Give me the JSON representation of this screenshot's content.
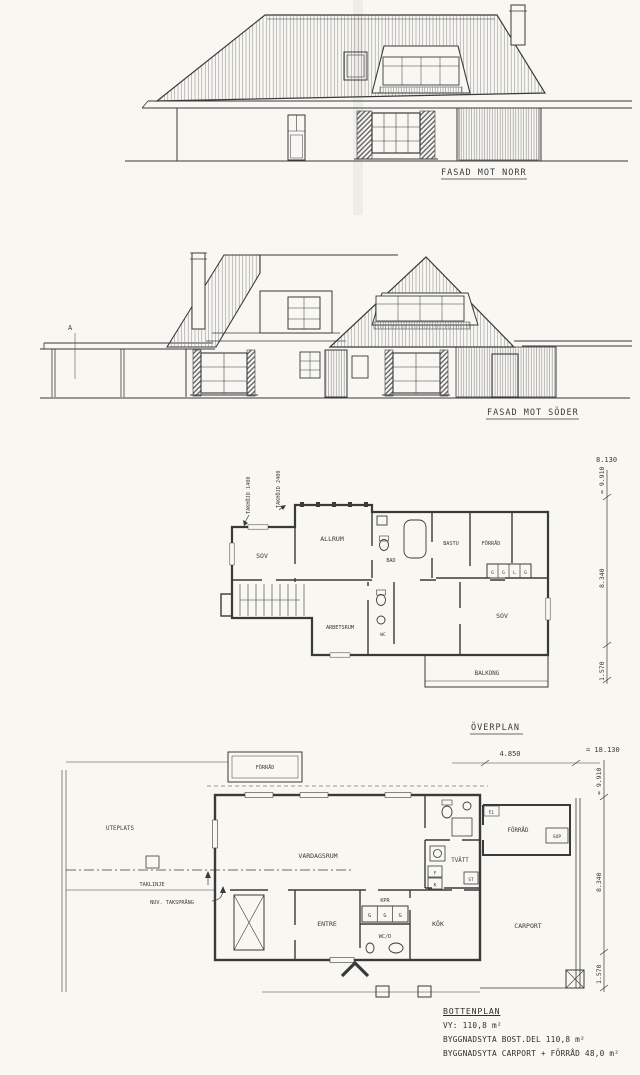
{
  "page": {
    "bg": "#f8f7f2",
    "ink": "#3a3a3a"
  },
  "elevations": {
    "north": {
      "caption": "FASAD MOT NORR"
    },
    "south": {
      "caption": "FASAD MOT SÖDER",
      "section_marker": "A"
    }
  },
  "overplan": {
    "caption": "ÖVERPLAN",
    "annotations": {
      "takhojd_low": "TAKHÖJD 1400",
      "takhojd_high": "TAKHÖJD 2400"
    },
    "rooms": {
      "sov_left": "SOV",
      "allrum": "ALLRUM",
      "bad": "BAD",
      "bastu": "BASTU",
      "forrad": "FÖRRÅD",
      "sov_right": "SOV",
      "arbetsrum": "ARBETSRUM",
      "wc": "WC",
      "balkong": "BALKONG"
    },
    "closets": [
      "G",
      "G",
      "L",
      "G"
    ],
    "dims": {
      "width_total": "8.130",
      "height_total": "= 9.910",
      "height_main": "8.340",
      "height_lower": "1.570"
    }
  },
  "bottenplan": {
    "rooms": {
      "forrad_top": "FÖRRÅD",
      "uteplats": "UTEPLATS",
      "vardagsrum": "VARDAGSRUM",
      "tvatt": "TVÄTT",
      "forrad_right": "FÖRRÅD",
      "sop": "SOP",
      "el": "EL",
      "entre": "ENTRE",
      "kpr": "KPR",
      "wcd": "WC/D",
      "kok": "KÖK",
      "carport": "CARPORT",
      "st": "ST",
      "frys": "F",
      "kyl": "K"
    },
    "closets": [
      "G",
      "G",
      "G"
    ],
    "annotations": {
      "taklinje": "TAKLINJE",
      "taksprang": "NUV. TAKSPRÅNG"
    },
    "dims": {
      "top_width": "4.850",
      "width_total": "= 18.130",
      "height_total": "= 9.910",
      "height_main": "8.340",
      "height_lower": "1.570"
    }
  },
  "notes": {
    "title": "BOTTENPLAN",
    "lines": [
      "VY: 110,8 m²",
      "BYGGNADSYTA BOST.DEL 110,8 m²",
      "BYGGNADSYTA CARPORT + FÖRRÅD 48,0 m²"
    ]
  }
}
